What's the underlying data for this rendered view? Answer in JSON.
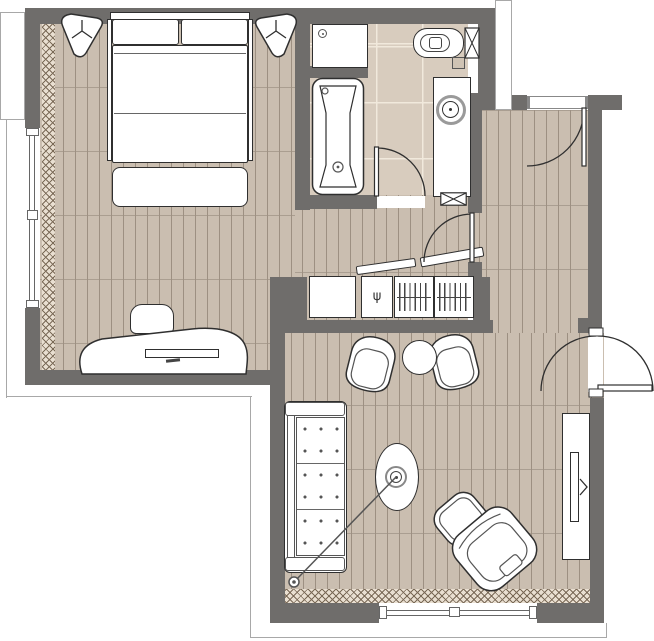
{
  "plan": {
    "type": "apartment-floor-plan",
    "canvas": {
      "width": 654,
      "height": 641
    },
    "colors": {
      "wall": "#6f6d6b",
      "wood": "#cabeb0",
      "wood_gap": "#9d9082",
      "tile": "#d8ccbe",
      "tile_line": "#f1e9dc",
      "curtain_bg": "#e9dfd1",
      "curtain_line": "#7a6a57",
      "stroke": "#2f2f2f",
      "thin_line": "#a8a8a8",
      "flush_plate": "#cfc3b4"
    },
    "symbols": {
      "wardrobe_hook_glyph": "ψ"
    },
    "rooms": [
      {
        "name": "bedroom",
        "furniture": [
          "double-bed",
          "pillow",
          "pillow",
          "bed-side-rails",
          "foot-bench",
          "corner-pouf-left",
          "corner-pouf-right",
          "desk",
          "desk-stool",
          "monitor"
        ],
        "window": "west",
        "curtain": true,
        "floor": "wood"
      },
      {
        "name": "bathroom",
        "furniture": [
          "shower-tray",
          "bathtub",
          "wall-hung-toilet",
          "flush-plate",
          "cistern",
          "vanity-counter",
          "round-washbasin"
        ],
        "floor": "tile"
      },
      {
        "name": "hallway",
        "furniture": [
          "wardrobe-cabinet",
          "coat-hook-compartment",
          "hanging-rail-compartment",
          "hanging-rail-compartment"
        ],
        "doors": [
          "entry-door",
          "bathroom-door",
          "inner-door",
          "double-swing-door"
        ],
        "floor": "wood"
      },
      {
        "name": "living-room",
        "furniture": [
          "three-seat-sofa",
          "armchair",
          "armchair",
          "round-side-table",
          "oval-coffee-table",
          "arc-floor-lamp",
          "lounge-chair",
          "ottoman",
          "tv-console",
          "tv"
        ],
        "window": "south",
        "curtain": true,
        "floor": "wood"
      }
    ]
  }
}
